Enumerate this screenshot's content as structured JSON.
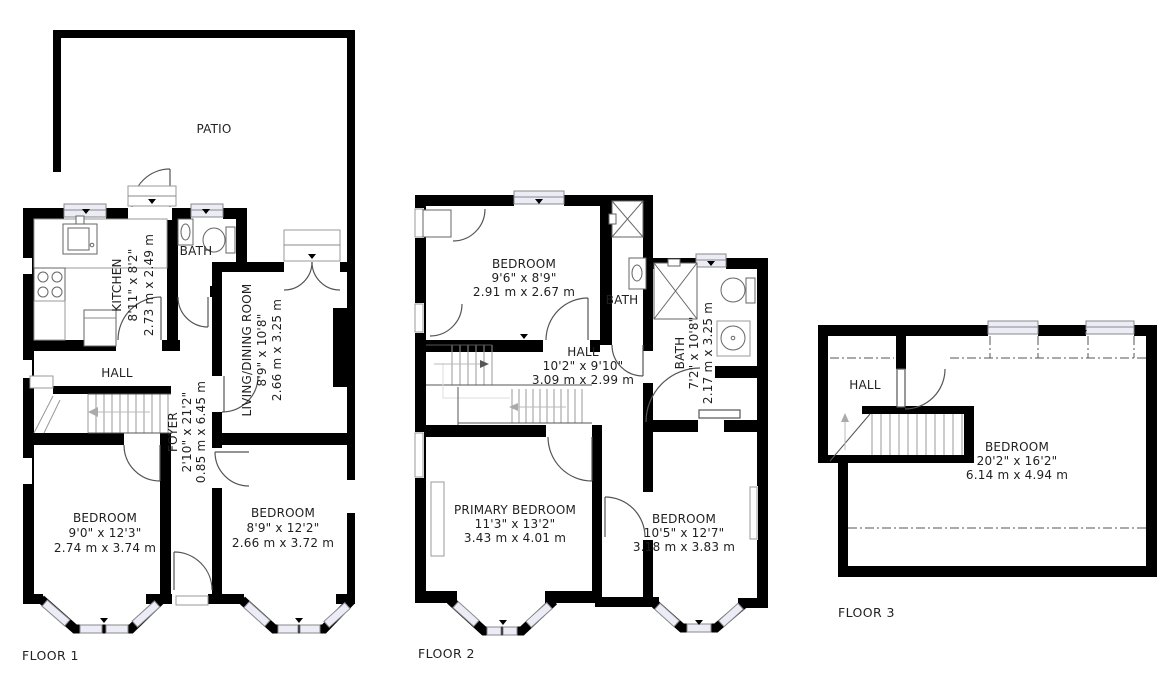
{
  "palette": {
    "wall": "#000000",
    "window_fill": "#ececf7",
    "line": "#555555",
    "text": "#1f1f1f"
  },
  "floors": [
    {
      "name": "FLOOR 1",
      "rooms": {
        "patio": {
          "label": "PATIO"
        },
        "kitchen": {
          "label": "KITCHEN",
          "ft": "8'11\" x 8'2\"",
          "m": "2.73 m x 2.49 m"
        },
        "bath": {
          "label": "BATH"
        },
        "living": {
          "label": "LIVING/DINING ROOM",
          "ft": "8'9\" x 10'8\"",
          "m": "2.66 m x 3.25 m"
        },
        "hall": {
          "label": "HALL"
        },
        "foyer": {
          "label": "FOYER",
          "ft": "2'10\" x 21'2\"",
          "m": "0.85 m x 6.45 m"
        },
        "bedroom_left": {
          "label": "BEDROOM",
          "ft": "9'0\" x 12'3\"",
          "m": "2.74 m x 3.74 m"
        },
        "bedroom_right": {
          "label": "BEDROOM",
          "ft": "8'9\" x 12'2\"",
          "m": "2.66 m x 3.72 m"
        }
      }
    },
    {
      "name": "FLOOR 2",
      "rooms": {
        "bedroom_top": {
          "label": "BEDROOM",
          "ft": "9'6\" x 8'9\"",
          "m": "2.91 m x 2.67 m"
        },
        "bath_small": {
          "label": "BATH"
        },
        "hall": {
          "label": "HALL",
          "ft": "10'2\" x 9'10\"",
          "m": "3.09 m x 2.99 m"
        },
        "bath": {
          "label": "BATH",
          "ft": "7'2\" x 10'8\"",
          "m": "2.17 m x 3.25 m"
        },
        "primary": {
          "label": "PRIMARY BEDROOM",
          "ft": "11'3\" x 13'2\"",
          "m": "3.43 m x 4.01 m"
        },
        "bedroom_bottom": {
          "label": "BEDROOM",
          "ft": "10'5\" x 12'7\"",
          "m": "3.18 m x 3.83 m"
        }
      }
    },
    {
      "name": "FLOOR 3",
      "rooms": {
        "hall": {
          "label": "HALL"
        },
        "bedroom": {
          "label": "BEDROOM",
          "ft": "20'2\" x 16'2\"",
          "m": "6.14 m x 4.94 m"
        }
      }
    }
  ]
}
